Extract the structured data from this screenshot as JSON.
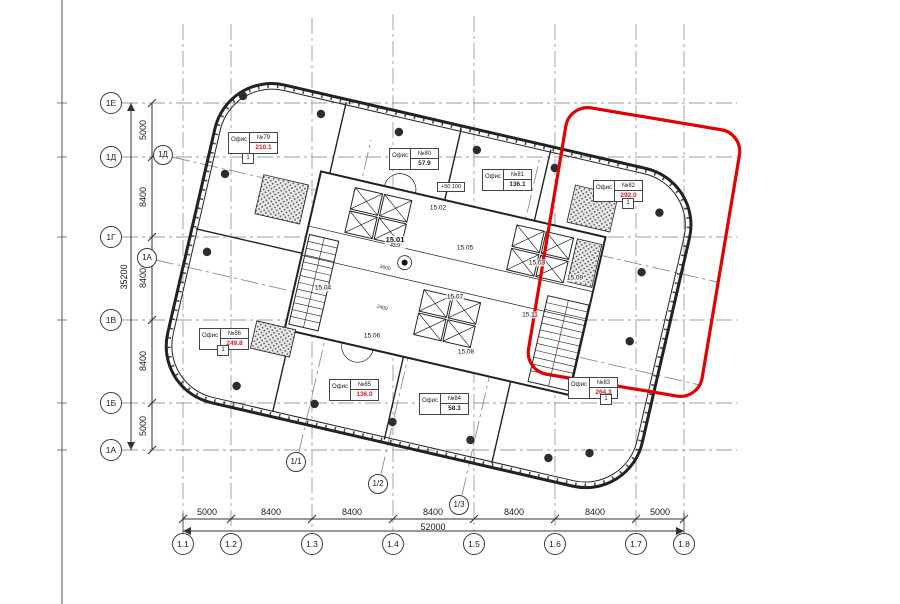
{
  "labels": {
    "office_word": "Офис",
    "tag": "1",
    "elevation": "+50.100"
  },
  "colors": {
    "highlight": "#e10000",
    "area_red": "#c52222",
    "line": "#2b2b2b",
    "grid": "#9b9b9b"
  },
  "axes": {
    "left": [
      {
        "label": "1Е"
      },
      {
        "label": "1Д"
      },
      {
        "label": "1Г"
      },
      {
        "label": "1В"
      },
      {
        "label": "1Б"
      },
      {
        "label": "1А"
      }
    ],
    "bottom": [
      {
        "label": "1.1"
      },
      {
        "label": "1.2"
      },
      {
        "label": "1.3"
      },
      {
        "label": "1.4"
      },
      {
        "label": "1.5"
      },
      {
        "label": "1.6"
      },
      {
        "label": "1.7"
      },
      {
        "label": "1.8"
      }
    ],
    "rotated": [
      {
        "label": "1Д"
      },
      {
        "label": "1А"
      },
      {
        "label": "1/1"
      },
      {
        "label": "1/2"
      },
      {
        "label": "1/3"
      }
    ]
  },
  "dims": {
    "left": {
      "segments": [
        "5000",
        "8400",
        "8400",
        "8400",
        "5000"
      ],
      "total": "35200"
    },
    "bottom": {
      "segments": [
        "5000",
        "8400",
        "8400",
        "8400",
        "8400",
        "8400",
        "5000"
      ],
      "total": "52000"
    },
    "core": [
      "3600",
      "2400"
    ]
  },
  "rooms": [
    {
      "id": "15.01",
      "sub": "43.9"
    },
    {
      "id": "15.02"
    },
    {
      "id": "15.03"
    },
    {
      "id": "15.04"
    },
    {
      "id": "15.05"
    },
    {
      "id": "15.06"
    },
    {
      "id": "15.07"
    },
    {
      "id": "15.08"
    },
    {
      "id": "15.09"
    },
    {
      "id": "15.11"
    }
  ],
  "offices": [
    {
      "no": "№79",
      "area": "210.1",
      "area_class": "ot-ar red"
    },
    {
      "no": "№80",
      "area": "57.9",
      "area_class": "ot-ar"
    },
    {
      "no": "№81",
      "area": "136.1",
      "area_class": "ot-ar"
    },
    {
      "no": "№82",
      "area": "292.0",
      "area_class": "ot-ar red"
    },
    {
      "no": "№83",
      "area": "264.3",
      "area_class": "ot-ar red"
    },
    {
      "no": "№84",
      "area": "58.3",
      "area_class": "ot-ar"
    },
    {
      "no": "№85",
      "area": "136.0",
      "area_class": "ot-ar red"
    },
    {
      "no": "№86",
      "area": "249.8",
      "area_class": "ot-ar red"
    }
  ]
}
